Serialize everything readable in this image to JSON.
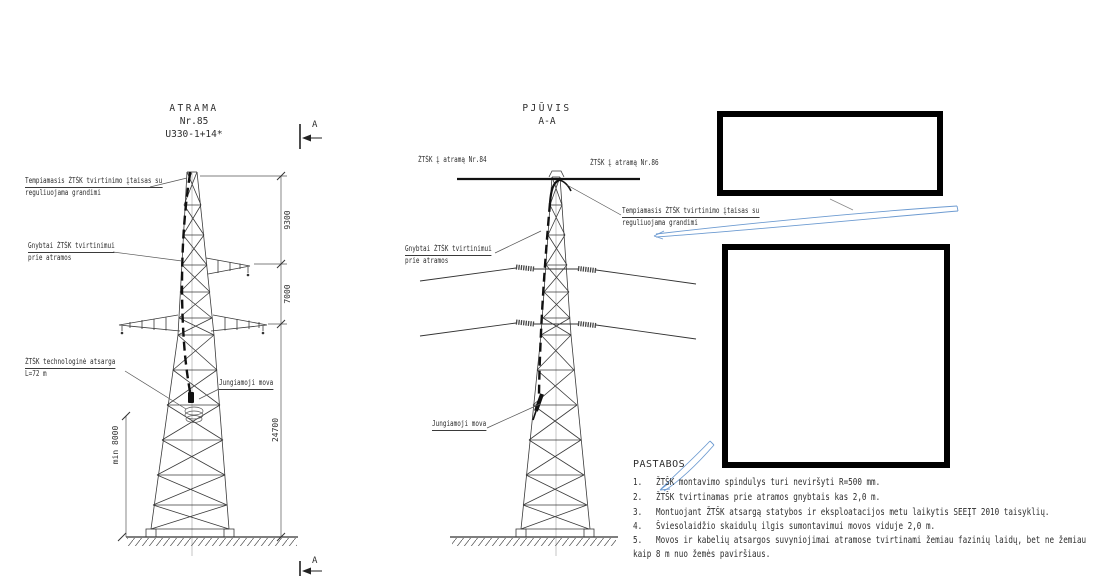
{
  "colors": {
    "background": "#ffffff",
    "line": "#3a3a3a",
    "cable": "#111111",
    "annotation_blue": "#6d9bd1",
    "redaction_border": "#000000"
  },
  "left_view": {
    "title_l1": "ATRAMA",
    "title_l2": "Nr.85",
    "title_l3": "U330-1+14*",
    "section_marker": "A",
    "labels": {
      "tension_l1": "Tempiamasis ŽTŠK tvirtinimo įtaisas su",
      "tension_l2": "reguliuojama grandimi",
      "clamps_l1": "Gnybtai ŽTŠK tvirtinimui",
      "clamps_l2": "prie atramos",
      "reserve_l1": "ŽTŠK technologinė atsarga",
      "reserve_l2": "L=72 m",
      "joint": "Jungiamoji mova"
    },
    "dimensions": {
      "upper": "9300",
      "middle": "7000",
      "lower": "24700",
      "min_clearance": "min 8000"
    }
  },
  "section_view": {
    "title_l1": "PJŪVIS",
    "title_l2": "A-A",
    "cable_to_84": "ŽTŠK į atramą Nr.84",
    "cable_to_86": "ŽTŠK į atramą Nr.86",
    "labels": {
      "tension_l1": "Tempiamasis ŽTŠK tvirtinimo įtaisas su",
      "tension_l2": "reguliuojama grandimi",
      "clamps_l1": "Gnybtai ŽTŠK tvirtinimui",
      "clamps_l2": "prie atramos",
      "joint": "Jungiamoji mova"
    }
  },
  "notes": {
    "title": "PASTABOS",
    "items": [
      {
        "num": "1.",
        "text": "ŽTŠK montavimo spindulys turi neviršyti R=500 mm."
      },
      {
        "num": "2.",
        "text": "ŽTŠK tvirtinamas prie atramos gnybtais kas 2,0 m."
      },
      {
        "num": "3.",
        "text": "Montuojant ŽTŠK atsargą statybos ir eksploatacijos metu laikytis SEEĮT 2010 taisyklių."
      },
      {
        "num": "4.",
        "text": "Šviesolaidžio skaidulų ilgis sumontavimui movos viduje 2,0 m."
      },
      {
        "num": "5.",
        "text": "Movos ir kabelių atsargos suvyniojimai atramose tvirtinami žemiau fazinių laidų, bet ne žemiau"
      }
    ],
    "item5_continuation": "kaip 8 m nuo žemės paviršiaus."
  }
}
